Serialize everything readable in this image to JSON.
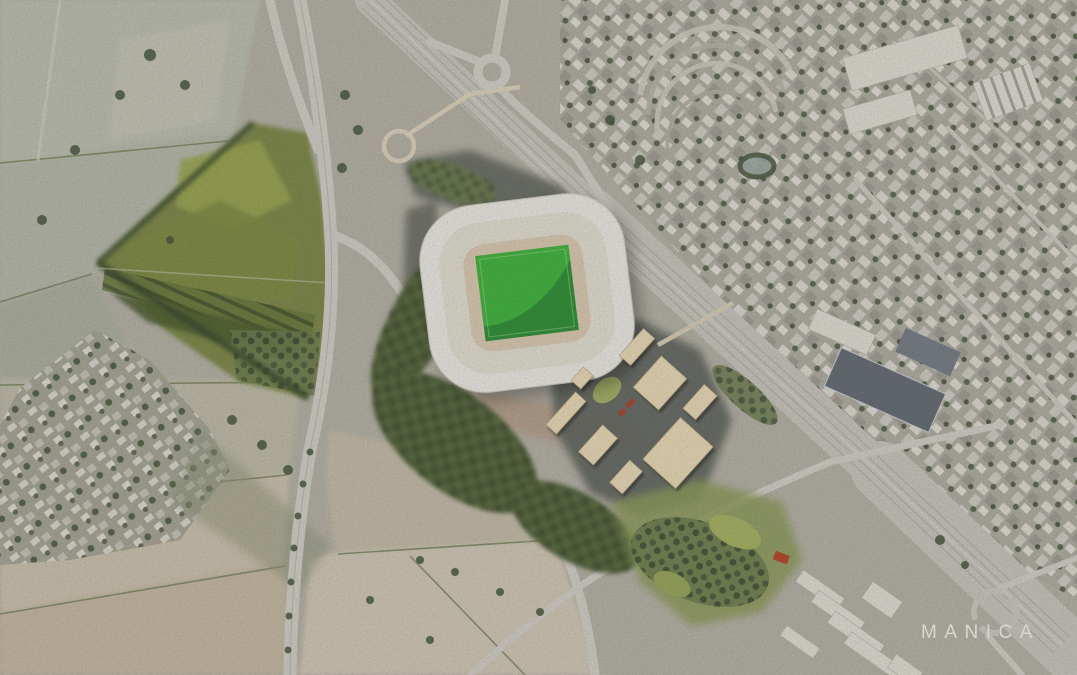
{
  "branding": {
    "studio_label": "MANICA"
  },
  "colors": {
    "base": "#b3afa4",
    "road": "#d0cdc5",
    "rail_corridor": "#c6c3bb",
    "field_beige": "#c9bfab",
    "park_green": "#7b8747",
    "tree_dark": "#46553a",
    "stadium_roof": "#e9e6df",
    "pitch_green": "#3fb13c",
    "pitch_shadow": "#2b8a33",
    "building_tan": "#e7d7b5",
    "plaza_dark": "#5e635b",
    "urban_light": "#dedbd2",
    "text_white": "#f2f0ec"
  }
}
